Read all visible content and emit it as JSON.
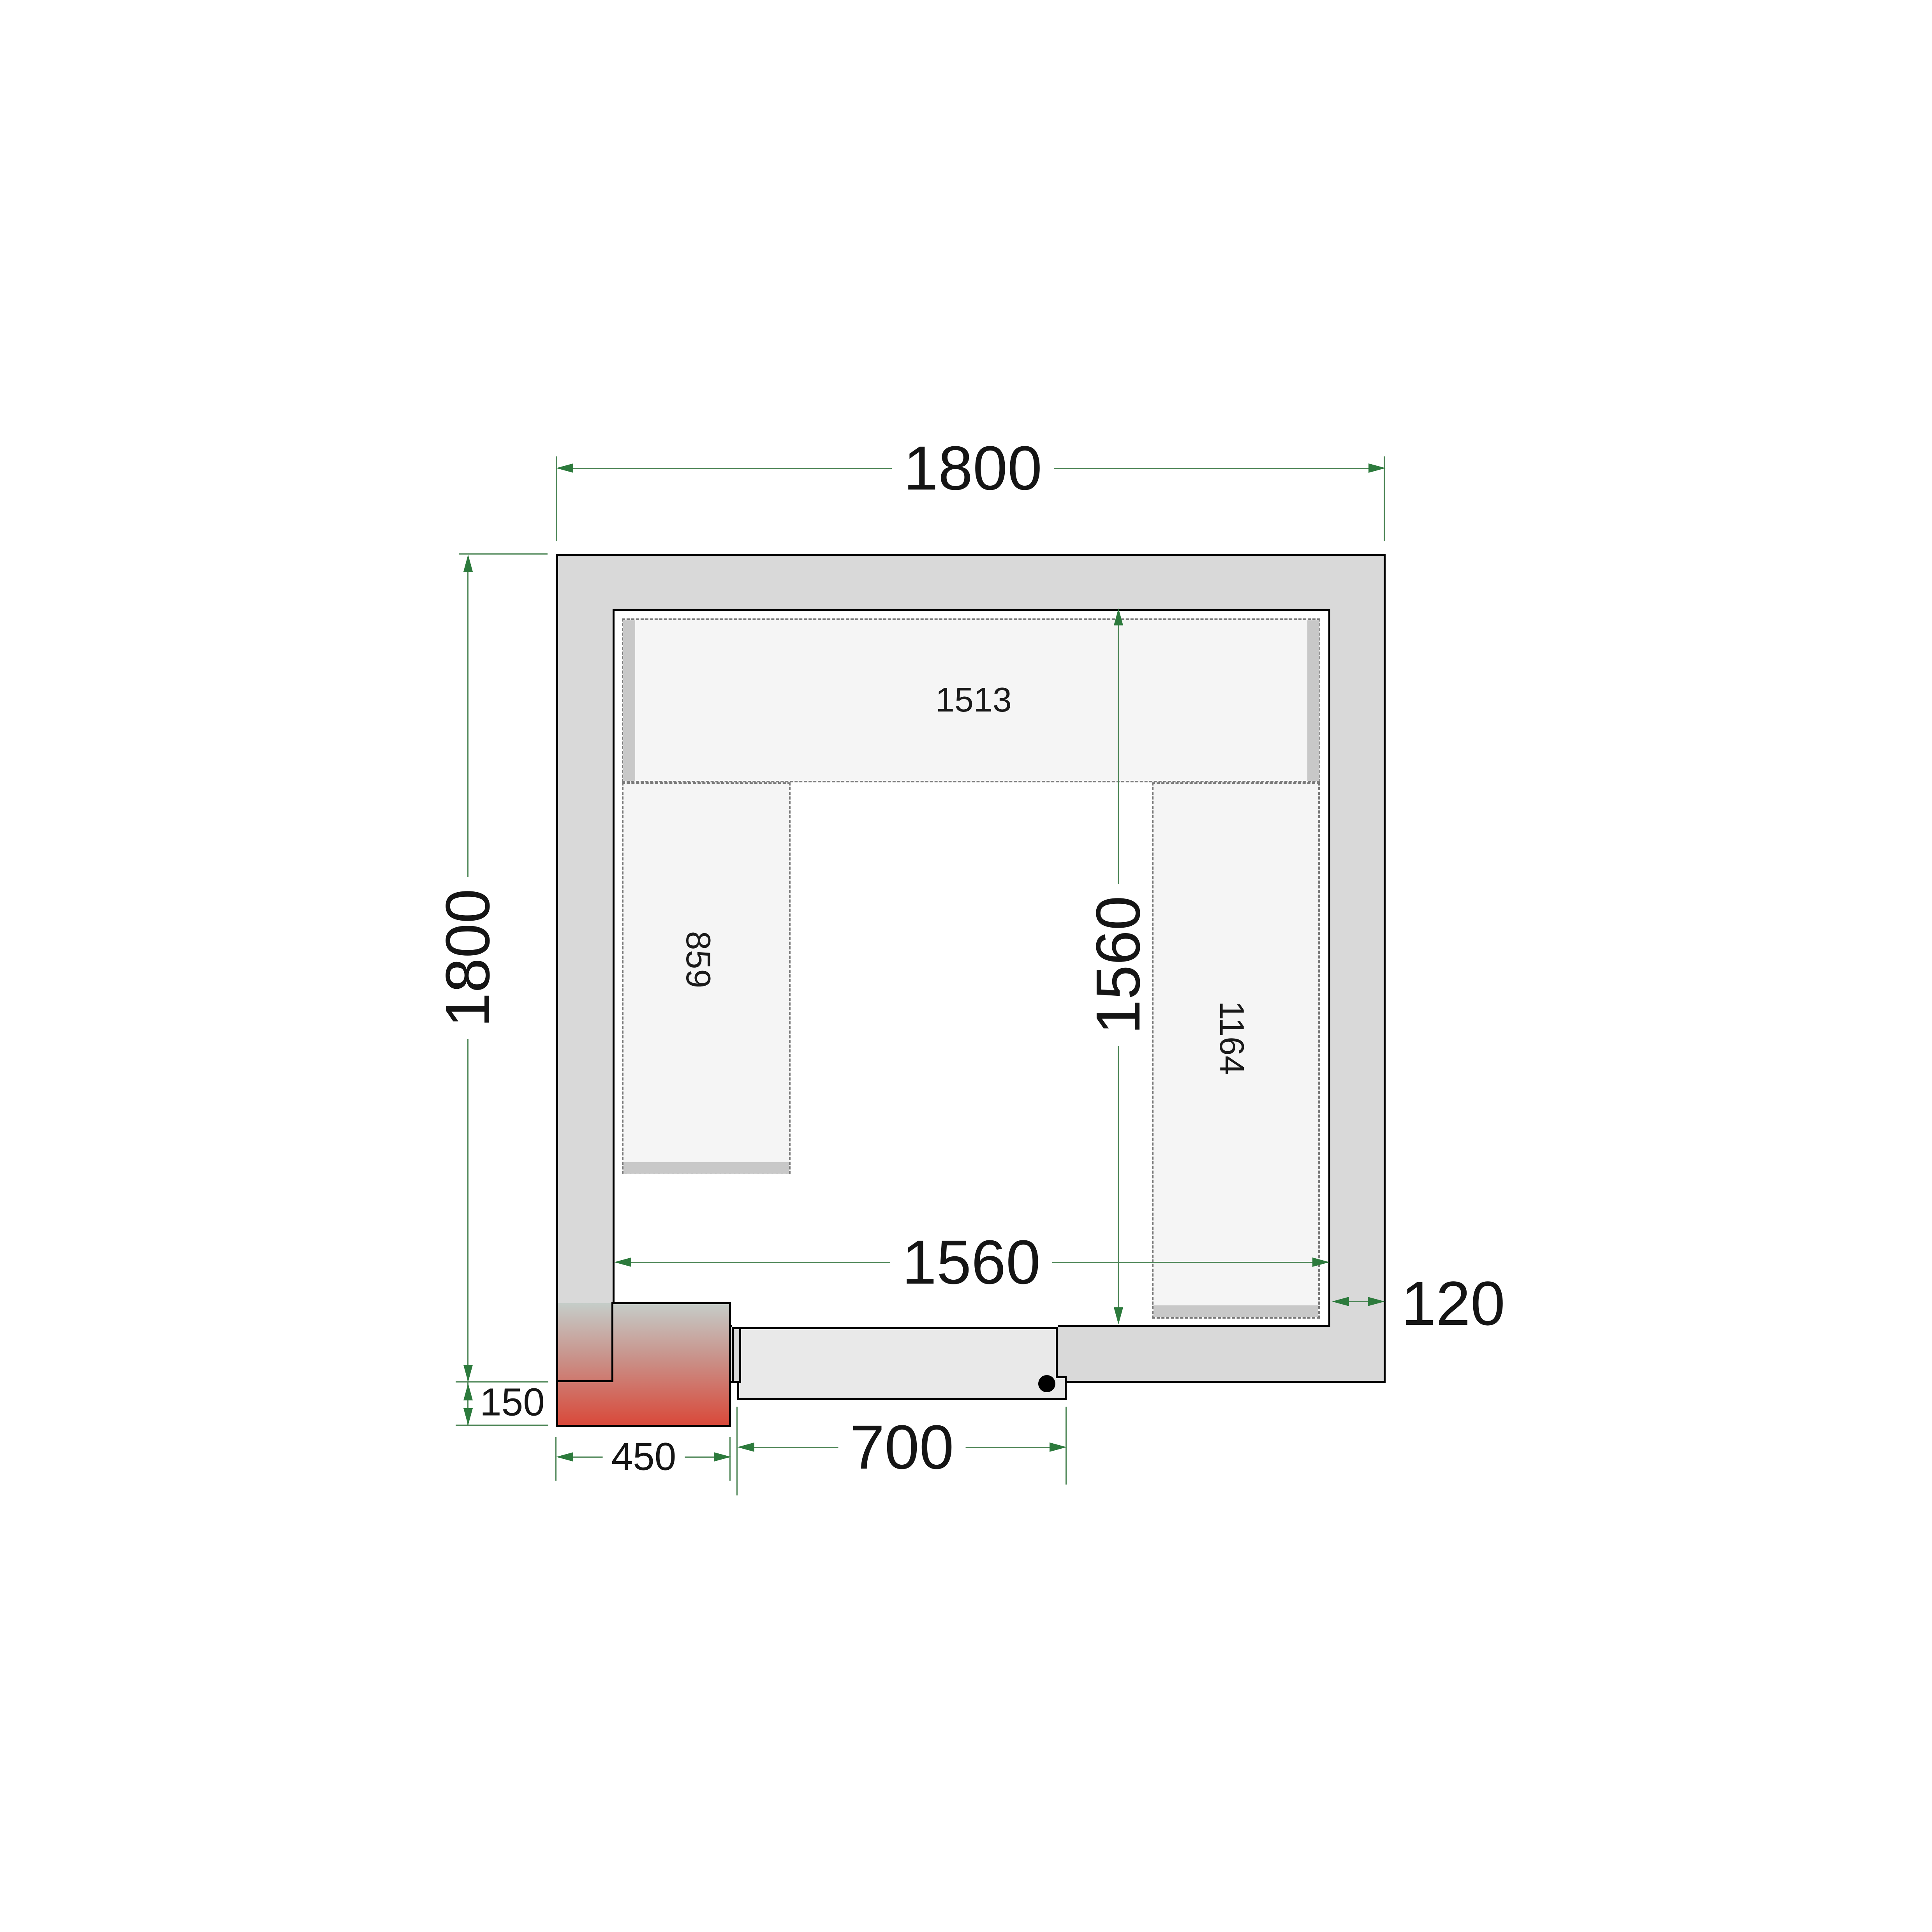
{
  "labels": {
    "outer_width": "1800",
    "outer_height": "1800",
    "inner_width": "1560",
    "inner_height": "1560",
    "wall_thickness": "120",
    "door_width": "700",
    "unit_width": "450",
    "unit_offset": "150",
    "shelf_top": "1513",
    "shelf_left": "859",
    "shelf_right": "1164"
  },
  "colors": {
    "wall": "#d9d9d9",
    "door": "#e9e9e9",
    "shelf": "#f5f5f5",
    "band": "#c8c8c8",
    "dash": "#7a7a7a",
    "dimline": "#4f8758",
    "dimarrow": "#2c7a3c",
    "dimtext": "#151515",
    "bg": "#ffffff"
  }
}
